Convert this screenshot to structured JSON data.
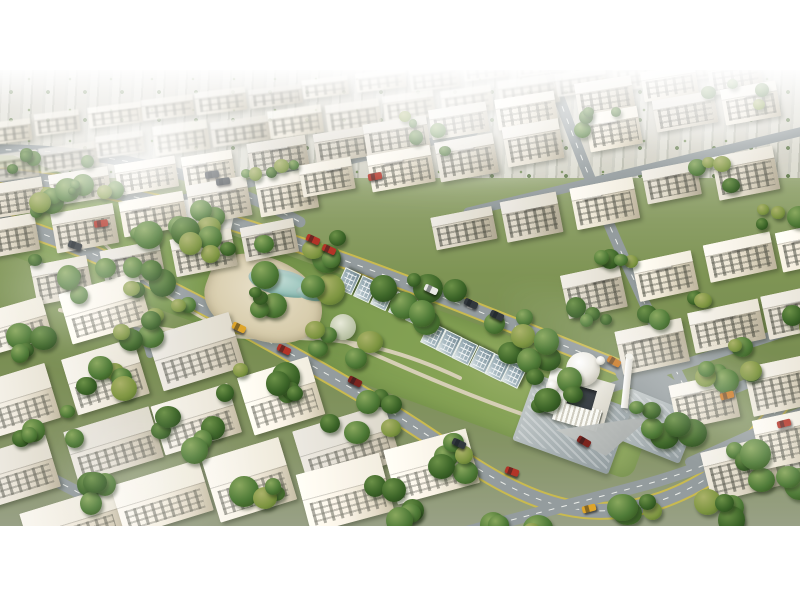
{
  "meta": {
    "description": "Aerial 3D architectural rendering of a master-planned residential compound: diagonal rows of cream low-rise apartment blocks, a central linear park with white tent pavilion, sand plaza, lagoon pool and glass pergola rows, a white domed mosque with minaret, curved yellow-edged roads with cars, dense trees, hazy white skyline, letterboxed on a white page.",
    "visible_text": []
  },
  "canvas": {
    "width": 800,
    "height": 600,
    "letterbox_color": "#ffffff",
    "photo_top": 70,
    "photo_height": 456
  },
  "palette": {
    "grass": "#7e9454",
    "grass_light": "#97ab67",
    "road_asphalt": "#949c9e",
    "road_edge_yellow": "#c9ba4f",
    "road_dash_white": "#eceeea",
    "park_path": "#d6cfb6",
    "sand": "#d8cdad",
    "water": "#9cc5bd",
    "building_cream": "#e4ddcc",
    "building_shadow": "#b7ae98",
    "roof_white": "#f3f0e8",
    "window_dark": "#4c4f46",
    "tree_green": "#4e7a37",
    "dome_white": "#edebe3",
    "cars": {
      "red": "#b33427",
      "darkred": "#7c241e",
      "yellow": "#dea52a",
      "orange": "#c8751f",
      "dark": "#32383d",
      "white": "#e8e9e4"
    }
  },
  "scene": {
    "lawn": {
      "x": -70,
      "y": 55,
      "w": 780,
      "h": 95,
      "rot": 20
    },
    "roads": [
      {
        "id": "road-top-left",
        "d": "M -20 80 C 55 78 125 88 180 104 C 230 118 268 134 300 152",
        "w": 11,
        "dash": true
      },
      {
        "id": "road-park-upper",
        "d": "M -20 104 C 80 110 185 136 285 170 C 385 203 475 240 555 272 C 610 294 645 308 682 322",
        "w": 13,
        "edge": true,
        "dash": true
      },
      {
        "id": "road-park-lower",
        "d": "M -30 142 C 60 164 150 207 240 256 C 312 295 378 332 430 367 C 470 394 515 426 565 437 C 615 448 663 434 701 412 C 737 391 766 356 793 318 L 820 278",
        "w": 14,
        "edge": true,
        "dash": true
      },
      {
        "id": "road-cross-right",
        "d": "M 549 0 C 571 62 601 140 635 212 C 655 256 670 290 686 320",
        "w": 11,
        "dash": true
      },
      {
        "id": "junction",
        "d": "M 630 300 L 672 326",
        "w": 30
      },
      {
        "id": "street-right-1",
        "d": "M 610 318 L 828 248",
        "w": 10
      },
      {
        "id": "street-right-2",
        "d": "M 650 352 L 828 282",
        "w": 10
      },
      {
        "id": "street-right-3",
        "d": "M 690 392 L 828 330",
        "w": 10
      },
      {
        "id": "street-bottom-right",
        "d": "M 436 470 L 640 416 C 690 403 740 382 800 352",
        "w": 12,
        "dash": true
      },
      {
        "id": "street-top-right",
        "d": "M 468 142 L 820 57",
        "w": 9
      },
      {
        "id": "street-top-mid",
        "d": "M 168 132 L 474 62",
        "w": 8
      },
      {
        "id": "street-bottom-left",
        "d": "M -20 378 C 40 400 92 428 138 458",
        "w": 12,
        "dash": true
      },
      {
        "id": "road-left-loop",
        "d": "M 40 196 C 70 206 95 218 115 234 C 135 250 146 266 150 284",
        "w": 8
      },
      {
        "id": "park-walk-1",
        "d": "M 60 240 C 130 256 210 268 290 268 C 350 268 400 280 460 308",
        "w": 4,
        "cls": "path"
      },
      {
        "id": "park-walk-2",
        "d": "M 90 160 C 120 190 160 226 210 252",
        "w": 3,
        "cls": "path"
      },
      {
        "id": "park-walk-3",
        "d": "M 250 230 C 330 262 420 310 545 352",
        "w": 4,
        "cls": "path"
      }
    ],
    "building_rows": [
      {
        "x": -20,
        "y": 52,
        "a": -7,
        "n": 13,
        "w": 48,
        "h": 22,
        "haze": true
      },
      {
        "x": -20,
        "y": 84,
        "a": -8,
        "n": 13,
        "w": 52,
        "h": 26,
        "haze": true
      },
      {
        "x": -18,
        "y": 118,
        "a": -9,
        "n": 6,
        "w": 56,
        "h": 32
      },
      {
        "x": 362,
        "y": 52,
        "a": -9,
        "n": 3,
        "w": 56,
        "h": 32
      },
      {
        "x": 574,
        "y": 14,
        "a": -9,
        "n": 3,
        "w": 56,
        "h": 32
      },
      {
        "x": -18,
        "y": 154,
        "a": -10,
        "n": 5,
        "w": 58,
        "h": 36
      },
      {
        "x": 298,
        "y": 96,
        "a": -10,
        "n": 4,
        "w": 58,
        "h": 36
      },
      {
        "x": 584,
        "y": 44,
        "a": -10,
        "n": 3,
        "w": 58,
        "h": 36
      },
      {
        "x": 30,
        "y": 196,
        "a": -11,
        "n": 4,
        "w": 60,
        "h": 38
      },
      {
        "x": 430,
        "y": 146,
        "a": -11,
        "n": 3,
        "w": 60,
        "h": 38
      },
      {
        "x": 642,
        "y": 104,
        "a": -11,
        "n": 2,
        "w": 60,
        "h": 38
      },
      {
        "x": 560,
        "y": 206,
        "a": -12,
        "n": 4,
        "w": 62,
        "h": 40
      },
      {
        "x": 614,
        "y": 260,
        "a": -12,
        "n": 3,
        "w": 64,
        "h": 42
      },
      {
        "x": 668,
        "y": 314,
        "a": -12,
        "n": 2,
        "w": 66,
        "h": 44
      },
      {
        "x": 700,
        "y": 382,
        "a": -14,
        "n": 2,
        "w": 68,
        "h": 46
      },
      {
        "x": 752,
        "y": 352,
        "a": -12,
        "n": 1,
        "w": 64,
        "h": 56
      },
      {
        "x": -24,
        "y": 246,
        "a": -16,
        "n": 2,
        "w": 74,
        "h": 50,
        "fg": true
      },
      {
        "x": -24,
        "y": 316,
        "a": -17,
        "n": 3,
        "w": 78,
        "h": 54,
        "fg": true
      },
      {
        "x": -24,
        "y": 388,
        "a": -17,
        "n": 4,
        "w": 80,
        "h": 56,
        "fg": true
      },
      {
        "x": 20,
        "y": 446,
        "a": -17,
        "n": 4,
        "w": 84,
        "h": 58,
        "fg": true
      },
      {
        "x": 296,
        "y": 406,
        "a": -15,
        "n": 2,
        "w": 80,
        "h": 56,
        "fg": true
      }
    ],
    "pergola_clusters": [
      {
        "x": 336,
        "y": 218,
        "a": 25,
        "n": 5,
        "step": 19,
        "w": 21,
        "h": 15
      },
      {
        "x": 420,
        "y": 272,
        "a": 26,
        "n": 6,
        "step": 18,
        "w": 21,
        "h": 16
      }
    ],
    "features": [
      {
        "type": "sand",
        "name": "sand-plaza",
        "x": 222,
        "y": 170,
        "w": 120,
        "h": 82,
        "rot": 20
      },
      {
        "type": "lagoon",
        "name": "lagoon-pool",
        "x": 252,
        "y": 192,
        "w": 66,
        "h": 26,
        "rot": 14
      },
      {
        "type": "lagoon",
        "name": "lagoon-pool-2",
        "x": 298,
        "y": 213,
        "w": 30,
        "h": 14,
        "rot": 14
      },
      {
        "type": "tent",
        "name": "tent-pavilion",
        "x": 152,
        "y": 132,
        "w": 62,
        "h": 26,
        "rot": -4
      },
      {
        "type": "tent",
        "name": "tent-pavilion-2",
        "x": 198,
        "y": 148,
        "w": 36,
        "h": 17,
        "rot": -4
      },
      {
        "type": "gazebo",
        "name": "gazebo",
        "x": 243,
        "y": 158,
        "w": 22,
        "h": 13,
        "rot": 10
      },
      {
        "type": "umbrella",
        "name": "parasol",
        "x": 330,
        "y": 244,
        "w": 26,
        "h": 26,
        "rot": 0
      },
      {
        "type": "plaza",
        "name": "paved-plaza",
        "x": 630,
        "y": 318,
        "w": 74,
        "h": 52,
        "rot": 22
      },
      {
        "type": "minimosque",
        "name": "distant-mosque",
        "x": 750,
        "y": 38
      }
    ],
    "mosque": {
      "x": 538,
      "y": 288
    },
    "tree_clusters": [
      [
        60,
        118,
        7,
        70,
        8
      ],
      [
        170,
        148,
        8,
        80,
        9
      ],
      [
        290,
        182,
        8,
        80,
        9
      ],
      [
        405,
        224,
        7,
        80,
        9
      ],
      [
        505,
        258,
        7,
        70,
        9
      ],
      [
        140,
        195,
        5,
        60,
        8
      ],
      [
        240,
        225,
        5,
        60,
        8
      ],
      [
        330,
        262,
        5,
        60,
        8
      ],
      [
        200,
        170,
        4,
        50,
        7
      ],
      [
        60,
        200,
        6,
        70,
        8
      ],
      [
        150,
        242,
        7,
        80,
        9
      ],
      [
        255,
        292,
        7,
        80,
        9
      ],
      [
        350,
        338,
        6,
        70,
        9
      ],
      [
        430,
        378,
        5,
        60,
        9
      ],
      [
        650,
        340,
        6,
        60,
        9
      ],
      [
        705,
        300,
        4,
        50,
        8
      ],
      [
        755,
        385,
        6,
        60,
        10
      ],
      [
        695,
        428,
        5,
        60,
        9
      ],
      [
        620,
        430,
        4,
        50,
        9
      ],
      [
        595,
        180,
        4,
        60,
        7
      ],
      [
        665,
        235,
        4,
        60,
        7
      ],
      [
        730,
        280,
        4,
        50,
        7
      ],
      [
        790,
        235,
        3,
        40,
        7
      ],
      [
        90,
        98,
        5,
        70,
        5
      ],
      [
        260,
        80,
        5,
        70,
        5
      ],
      [
        430,
        60,
        5,
        70,
        5
      ],
      [
        600,
        38,
        4,
        60,
        5
      ],
      [
        730,
        24,
        4,
        60,
        5
      ],
      [
        20,
        86,
        4,
        50,
        5
      ],
      [
        95,
        295,
        5,
        60,
        8
      ],
      [
        35,
        345,
        5,
        60,
        9
      ],
      [
        175,
        352,
        5,
        60,
        9
      ],
      [
        100,
        415,
        4,
        50,
        9
      ],
      [
        255,
        420,
        5,
        60,
        9
      ],
      [
        10,
        260,
        4,
        50,
        8
      ],
      [
        385,
        420,
        5,
        60,
        9
      ],
      [
        500,
        452,
        4,
        50,
        9
      ],
      [
        775,
        135,
        4,
        50,
        7
      ],
      [
        700,
        95,
        4,
        50,
        6
      ],
      [
        545,
        310,
        5,
        60,
        8
      ],
      [
        575,
        238,
        4,
        50,
        7
      ]
    ],
    "cars": [
      [
        94,
        150,
        "red",
        -8
      ],
      [
        68,
        172,
        "dark",
        20
      ],
      [
        205,
        101,
        "dark",
        -8
      ],
      [
        216,
        108,
        "dark",
        -8
      ],
      [
        368,
        103,
        "red",
        -10
      ],
      [
        306,
        166,
        "red",
        24
      ],
      [
        322,
        176,
        "red",
        24
      ],
      [
        424,
        216,
        "white",
        25
      ],
      [
        464,
        230,
        "dark",
        25
      ],
      [
        490,
        242,
        "dark",
        25
      ],
      [
        232,
        254,
        "yellow",
        26
      ],
      [
        277,
        276,
        "red",
        26
      ],
      [
        348,
        308,
        "darkred",
        27
      ],
      [
        452,
        370,
        "dark",
        25
      ],
      [
        505,
        398,
        "red",
        20
      ],
      [
        577,
        368,
        "darkred",
        30
      ],
      [
        607,
        288,
        "orange",
        30
      ],
      [
        582,
        435,
        "yellow",
        -15
      ],
      [
        720,
        322,
        "orange",
        -14
      ],
      [
        777,
        350,
        "red",
        -14
      ]
    ],
    "fog": [
      {
        "x": -40,
        "y": -10,
        "w": 360,
        "h": 190,
        "o": 0.95,
        "blur": 18,
        "rot": 0
      },
      {
        "x": 250,
        "y": -20,
        "w": 420,
        "h": 140,
        "o": 0.85,
        "blur": 16,
        "rot": 0
      },
      {
        "x": 560,
        "y": -20,
        "w": 300,
        "h": 120,
        "o": 0.7,
        "blur": 14,
        "rot": 0
      },
      {
        "x": -30,
        "y": 150,
        "w": 240,
        "h": 140,
        "o": 0.45,
        "blur": 14,
        "rot": 0
      },
      {
        "x": 520,
        "y": 170,
        "w": 460,
        "h": 110,
        "o": 0.3,
        "blur": 10,
        "rot": 27
      },
      {
        "x": 40,
        "y": 330,
        "w": 200,
        "h": 160,
        "o": 0.22,
        "blur": 12,
        "rot": 0
      }
    ]
  }
}
